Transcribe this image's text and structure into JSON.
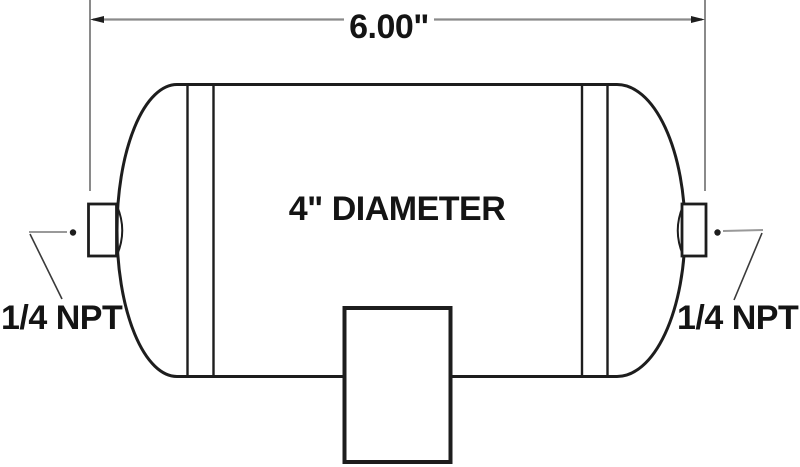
{
  "diagram": {
    "type": "technical-drawing",
    "subject": "air tank side view",
    "length_dimension_label": "6.00\"",
    "diameter_label": "4\" DIAMETER",
    "left_port_label": "1/4 NPT",
    "right_port_label": "1/4 NPT"
  },
  "colors": {
    "background": "#ffffff",
    "outline": "#1d1d1d",
    "dimension_line": "#8a8a8a",
    "leader_line": "#3a3a3a",
    "text": "#141414"
  }
}
